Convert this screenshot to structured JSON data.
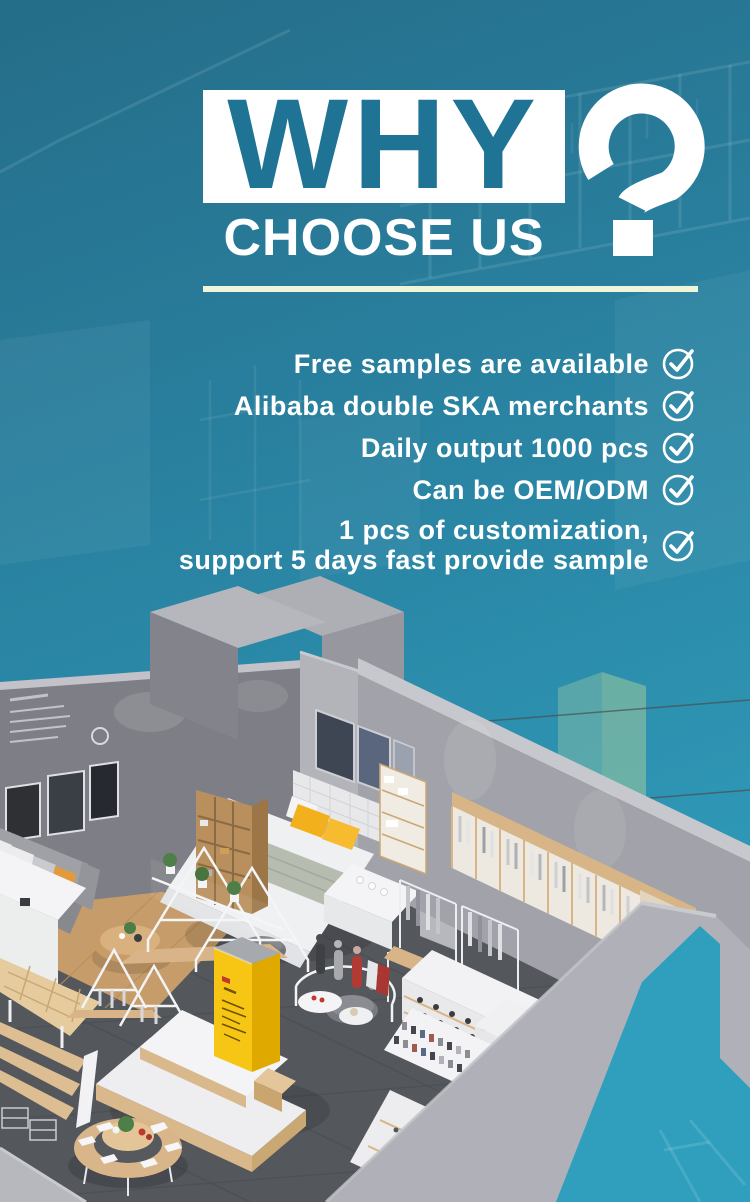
{
  "hero": {
    "title": "WHY",
    "subtitle": "CHOOSE US",
    "question_mark": "?",
    "title_color": "#1f7394",
    "title_box_bg": "#ffffff",
    "divider_color": "#eef5d8"
  },
  "benefits": {
    "text_color": "#ffffff",
    "check_icon": "check-circle-icon",
    "items": [
      {
        "text": "Free samples are available"
      },
      {
        "text": "Alibaba double SKA merchants"
      },
      {
        "text": "Daily output 1000 pcs"
      },
      {
        "text": "Can be OEM/ODM"
      },
      {
        "text": "1 pcs of customization,\nsupport 5 days fast provide sample"
      }
    ]
  },
  "scene": {
    "background_teal_top": "#256d89",
    "background_teal_bottom": "#33a6c4",
    "kiosk_yellow": "#f7c513",
    "wall_gray": "#a2a3aa",
    "floor_gray": "#54575c",
    "wood_light": "#d9b58a"
  }
}
